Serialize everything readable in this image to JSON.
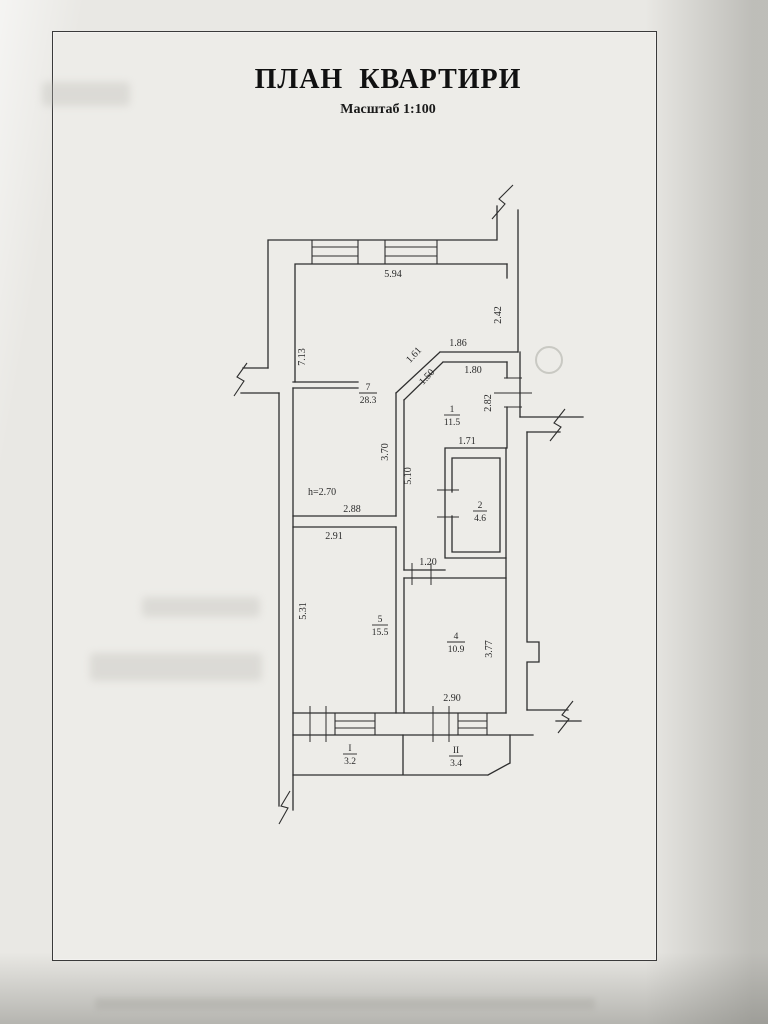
{
  "document": {
    "title": "ПЛАН  КВАРТИРИ",
    "subtitle": "Масштаб 1:100"
  },
  "plan": {
    "height_label": "h=2.70",
    "rooms": {
      "r7": {
        "num": "7",
        "area": "28.3"
      },
      "r1": {
        "num": "1",
        "area": "11.5"
      },
      "r2": {
        "num": "2",
        "area": "4.6"
      },
      "r5": {
        "num": "5",
        "area": "15.5"
      },
      "r4": {
        "num": "4",
        "area": "10.9"
      },
      "b1": {
        "num": "I",
        "area": "3.2"
      },
      "b2": {
        "num": "II",
        "area": "3.4"
      }
    },
    "dims": {
      "top_width": "5.94",
      "right_top": "2.42",
      "left_height": "7.13",
      "hall_top1": "1.86",
      "hall_top2": "1.80",
      "diag1": "1.61",
      "diag2": "1.50",
      "hall_right": "2.82",
      "bath_top": "1.71",
      "mid_upper": "3.70",
      "mid_lower": "5.10",
      "room7_bottom": "2.88",
      "room5_top": "2.91",
      "door_width": "1.20",
      "room5_left": "5.31",
      "room4_right": "3.77",
      "room4_bottom": "2.90"
    },
    "colors": {
      "line": "#2e2e2e",
      "height_label": "#2f62ac",
      "ink": "#1d1d1d"
    }
  }
}
